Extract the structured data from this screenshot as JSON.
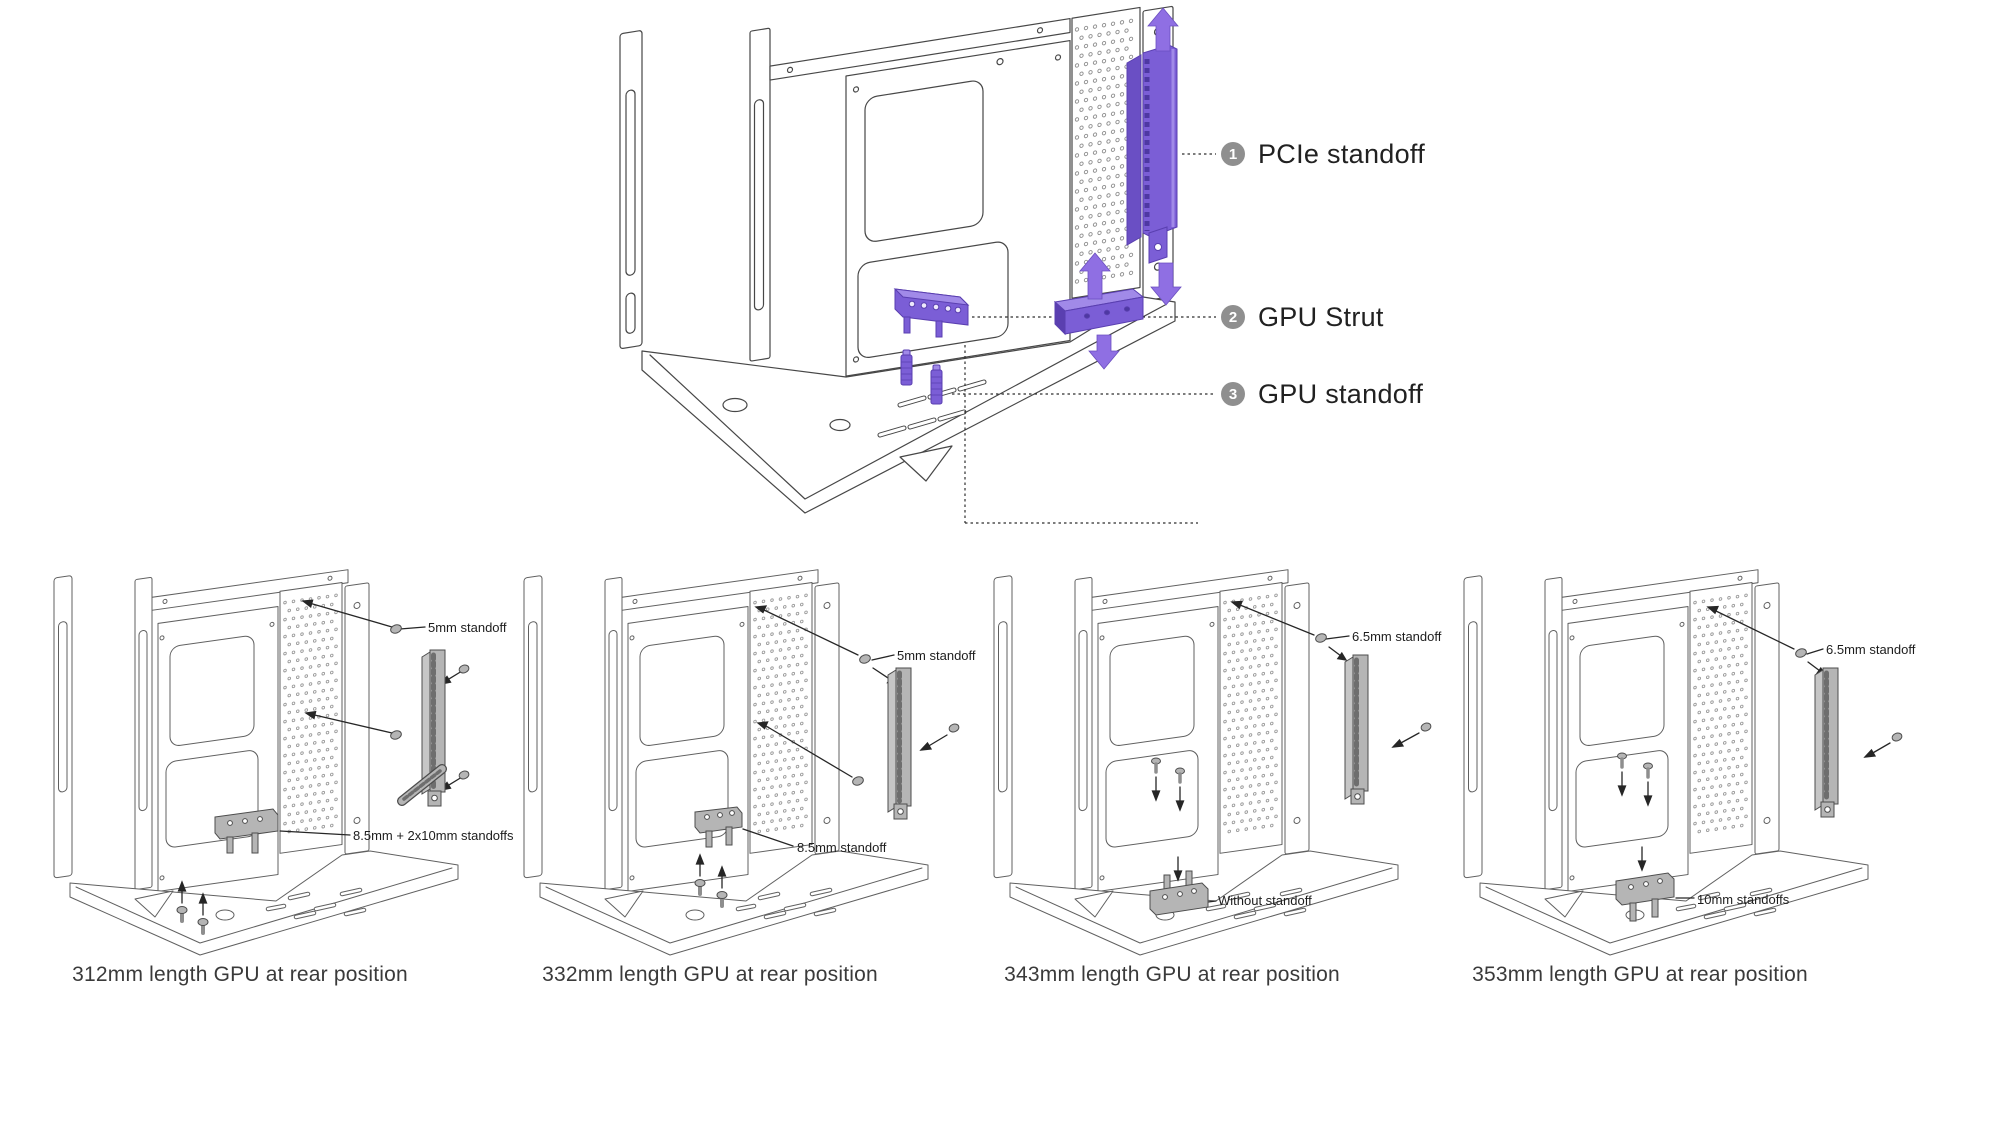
{
  "colors": {
    "accent_purple": "#7B5ED6",
    "accent_purple_dark": "#5A3FB0",
    "accent_purple_light": "#A18AE8",
    "arrow_purple": "#8F6FE3",
    "badge_gray": "#8F8F8F",
    "part_gray": "#B5B5B5",
    "line_art_gray": "#4A4A4A",
    "label_text": "#1D1D1D"
  },
  "main_diagram": {
    "callouts": [
      {
        "number": "1",
        "label": "PCIe standoff"
      },
      {
        "number": "2",
        "label": "GPU Strut"
      },
      {
        "number": "3",
        "label": "GPU standoff"
      }
    ]
  },
  "variants": [
    {
      "caption": "312mm length GPU at rear position",
      "top_label": "5mm standoff",
      "bottom_label": "8.5mm + 2x10mm standoffs"
    },
    {
      "caption": "332mm length GPU at rear position",
      "top_label": "5mm standoff",
      "bottom_label": "8.5mm standoff"
    },
    {
      "caption": "343mm length GPU at rear position",
      "top_label": "6.5mm standoff",
      "bottom_label": "Without standoff"
    },
    {
      "caption": "353mm length GPU at rear position",
      "top_label": "6.5mm standoff",
      "bottom_label": "10mm standoffs"
    }
  ],
  "icons": {
    "up_arrow": "block-arrow-up",
    "down_arrow": "block-arrow-down",
    "screw": "screw-glyph",
    "callout_badge": "numbered-circle"
  }
}
